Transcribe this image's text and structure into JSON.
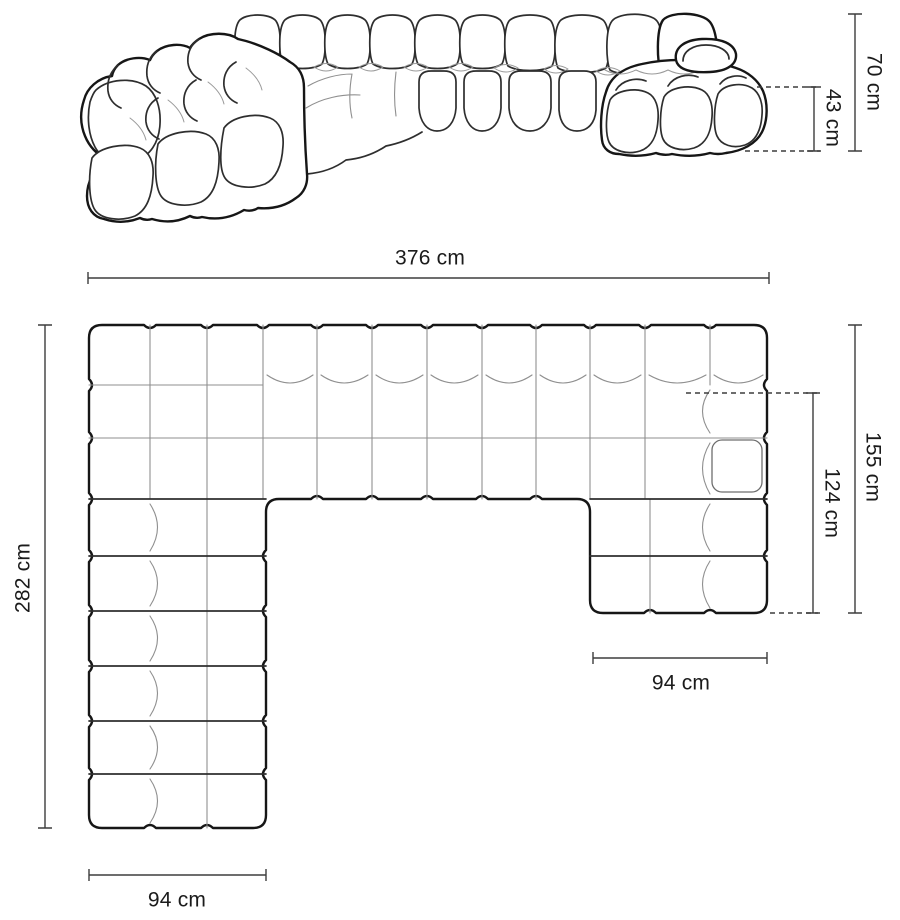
{
  "front_view": {
    "height_label": "70 cm",
    "seat_height_label": "43 cm"
  },
  "width_label": "376 cm",
  "top_view": {
    "depth_label": "282 cm",
    "right_depth_label": "155 cm",
    "chaise_length_label": "124 cm",
    "chaise_width_label": "94 cm",
    "module_width_label": "94 cm"
  },
  "colors": {
    "outline": "#161616",
    "thin_line": "#8f8f8f",
    "dimension_line": "#3d3d3d",
    "text": "#1b1b1b",
    "background": "#ffffff"
  }
}
